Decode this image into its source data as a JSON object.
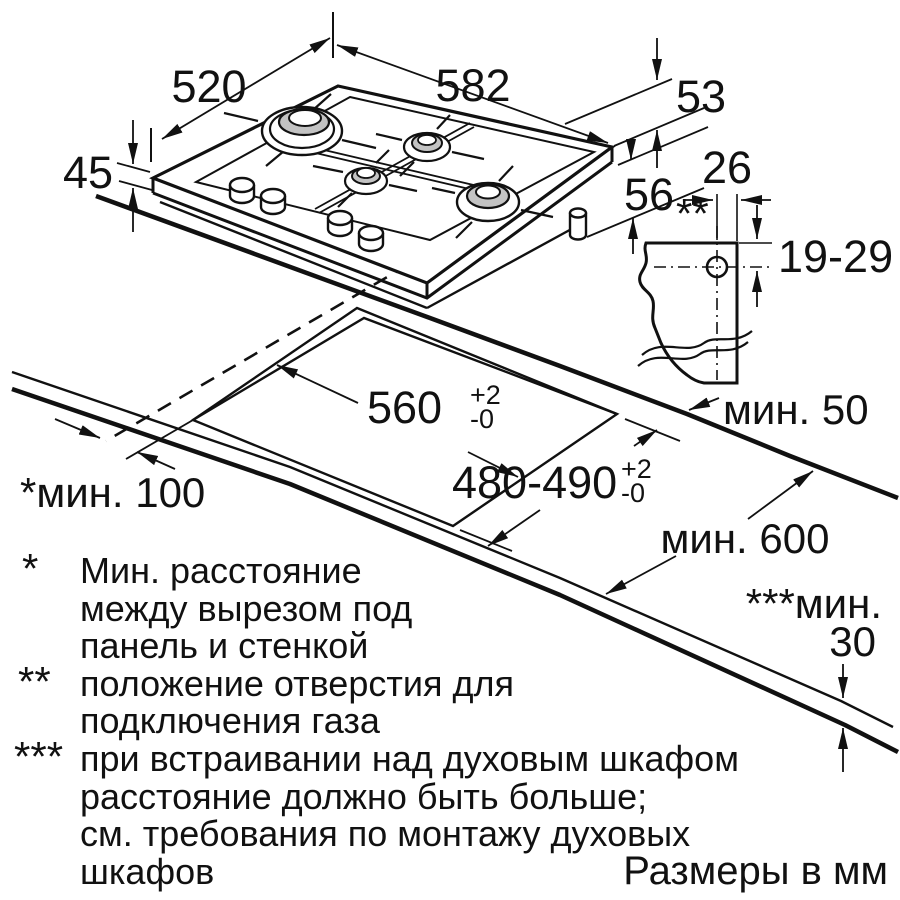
{
  "hob": {
    "width": "582",
    "depth": "520",
    "height_above": "45",
    "back_gap": "53",
    "body_depth": "56"
  },
  "gas": {
    "offset": "26",
    "marker": "**",
    "vertical_range": "19-29",
    "min_rear_gap": "мин. 50"
  },
  "cutout": {
    "width": "560",
    "width_tol_plus": "+2",
    "width_tol_minus": "-0",
    "depth": "480-490",
    "depth_tol_plus": "+2",
    "depth_tol_minus": "-0",
    "min_side_gap": "*мин. 100",
    "min_worktop_depth": "мин. 600",
    "min_front_label": "***мин.",
    "min_front_value": "30"
  },
  "footnotes": {
    "note1_marker": "*",
    "note1_line1": "Мин. расстояние",
    "note1_line2": "между вырезом под",
    "note1_line3": "панель и стенкой",
    "note2_marker": "**",
    "note2_line1": "положение отверстия для",
    "note2_line2": "подключения газа",
    "note3_marker": "***",
    "note3_line1": "при встраивании над духовым шкафом",
    "note3_line2": "расстояние должно быть больше;",
    "note3_line3": "см. требования по монтажу духовых",
    "note3_line4": "шкафов",
    "units_note": "Размеры в мм"
  }
}
